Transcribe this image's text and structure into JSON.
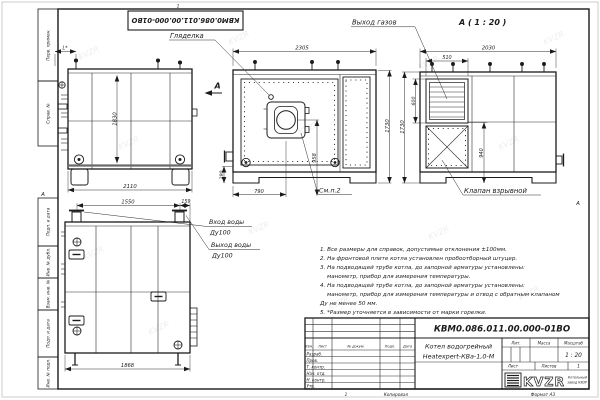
{
  "page": {
    "watermark": "KVZR"
  },
  "frame": {
    "zone_top": "1",
    "zone_bottom": "1",
    "zone_left": "А",
    "zone_right": "А",
    "margin_top": [
      "Перв. примен.",
      "Справ. №"
    ],
    "margin_bottom": [
      "Подп. и дата",
      "Инв. № дубл.",
      "Взам. инв. №",
      "Подп. и дата",
      "Инв. № подл."
    ]
  },
  "stamp": {
    "designation": "КВМ0.086.011.00.000-01ВО"
  },
  "views": {
    "direction_arrow": "А",
    "side": {
      "dim_l": "L*",
      "dim_height": "1830",
      "dim_width": "2110"
    },
    "front": {
      "label_peephole": "Гляделка",
      "dim_width": "2305",
      "dim_height": "1730",
      "dim_burner_axis": "958",
      "dim_burner_x": "790",
      "dim_base": "290",
      "label_see": "См.п.2"
    },
    "rear": {
      "view_title": "А ( 1 : 20 )",
      "label_gas_outlet": "Выход газов",
      "label_valve": "Клапан взрывной",
      "dim_width": "2030",
      "dim_grille_width": "510",
      "dim_grille_height": "600",
      "dim_height": "1730",
      "dim_mid": "940"
    },
    "piping": {
      "dim_pipes": "1550",
      "dim_edge": "159",
      "dim_bottom": "1868",
      "label_inlet": "Вход воды",
      "label_inlet_dn": "Ду100",
      "label_outlet": "Выход воды",
      "label_outlet_dn": "Ду100"
    }
  },
  "notes": [
    "1. Все размеры для справок, допустимые отклонения ±100мм.",
    "2. На фронтовой плите котла установлен пробоотборный штуцер.",
    "3. На подводящей трубе котла, до запорной арматуры установлены:",
    "манометр, прибор для измерения температуры.",
    "4. На подводящей трубе котла, до запорной арматуры установлены:",
    "манометр, прибор для измерения температуры и отвод с обратным клапаном",
    "Ду не менее 50 мм.",
    "5. *Размер уточняется в зависимости от марки горелки."
  ],
  "title_block": {
    "designation": "КВМ0.086.011.00.000-01ВО",
    "product_name_1": "Котел водогрейный",
    "product_name_2": "Heatexpert-КВа-1,0-М",
    "col_izm": "Изм.",
    "col_list": "Лист",
    "col_docnum": "№ докум.",
    "col_podp": "Подп.",
    "col_data": "Дата",
    "row_razrab": "Разраб.",
    "row_prov": "Пров.",
    "row_tkontr": "Т. контр.",
    "row_nachotd": "Нач. отд.",
    "row_nkontr": "Н. контр.",
    "row_utv": "Утв.",
    "lit_label": "Лит.",
    "mass_label": "Масса",
    "scale_label": "Масштаб",
    "scale_value": "1 : 20",
    "sheet_label": "Лист",
    "sheets_label": "Листов",
    "sheets_value": "1",
    "logo_text": "KVZR",
    "logo_caption_1": "Котельный",
    "logo_caption_2": "завод КВЗР",
    "footer_copied": "Копировал",
    "footer_format": "Формат А3"
  }
}
